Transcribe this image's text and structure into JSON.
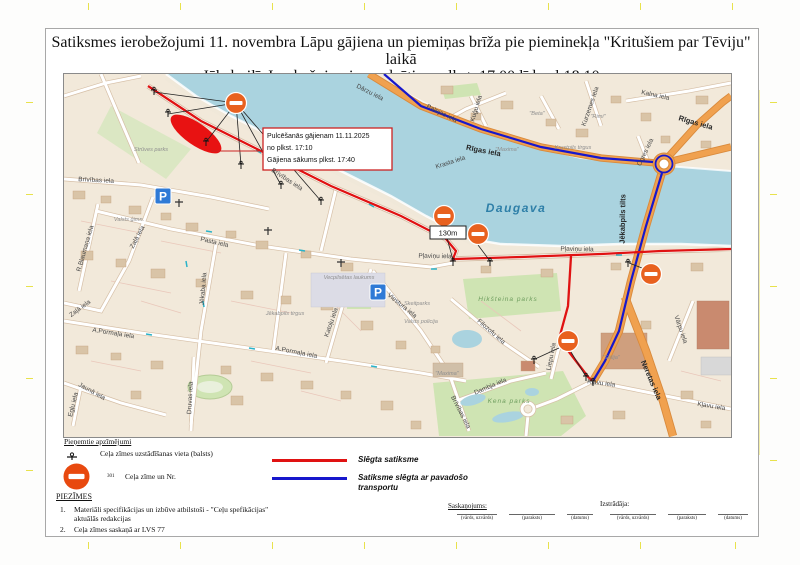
{
  "title": {
    "line1": "Satiksmes ierobežojumi 11. novembra Lāpu gājiena un piemiņas brīža pie pieminekļa \"Kritušiem par Tēviju\" laikā",
    "line2": "Jēkabpilī. Ierobežojumi paredzēti no plkst. 17.00 līdz pl.18.10"
  },
  "map": {
    "parking_letter": "P",
    "distance_label": "130m",
    "callout": {
      "line1": "Pulcēšanās gājienam 11.11.2025",
      "line2": "no plkst. 17:10",
      "line3": "Gājiena sākums plkst. 17:40"
    },
    "labels": [
      "Strūves parks",
      "Brīvības iela",
      "Brīvības iela",
      "Zaļā iela",
      "Pasta iela",
      "R.Blaumaņa iela",
      "Jēkaba iela",
      "A.Pormaļa iela",
      "A.Pormaļa iela",
      "Jaunā iela",
      "Egļu iela",
      "Druvas iela",
      "Katoļu iela",
      "Viestura iela",
      "Vecpilsētas laukums",
      "Jēkabpils tirgus",
      "Daugava",
      "Rīgas iela",
      "Rīgas iela",
      "Palejas iela",
      "Kalna iela",
      "Kuģu iela",
      "Krasta iela",
      "Ogres iela",
      "Kurzemes iela",
      "Krustpils tirgus",
      "\"Maxima\"",
      "\"Rimi\"",
      "\"Beta\"",
      "Jēkabpils tilts",
      "Pļaviņu iela",
      "Pļaviņu iela",
      "Hikšteina parks",
      "Skeitparks",
      "Valsts policija",
      "\"Maxima\"",
      "Filozofu iela",
      "Dambja iela",
      "Kena parks",
      "\"Sēlija\"",
      "Neretas iela",
      "Vārpu iela",
      "Kļavu iela",
      "Kļavu iela",
      "Liepu iela",
      "Valsts ģimn.",
      "Dārzu iela",
      "Zaļā iela",
      "Brīvības iela"
    ]
  },
  "legend": {
    "heading": "Pieņemtie apzīmējumi",
    "item1_label": "Ceļa zīmes uzstādīšanas vieta (balsts)",
    "item2_number": "301",
    "item2_label": "Ceļa zīme un Nr.",
    "line1_label": "Slēgta satiksme",
    "line2_label": "Satiksme slēgta ar pavadošo transportu",
    "line1_color": "#e01212",
    "line2_color": "#1717cc"
  },
  "notes": {
    "heading": "PIEZĪMES",
    "item1_num": "1.",
    "item1": "Materiāli specifikācijas un izbūve atbilstoši - \"Ceļu spefikācijas\" aktuālās redakcijas",
    "item2_num": "2.",
    "item2": "Ceļa zīmes saskaņā ar LVS 77"
  },
  "signoff": {
    "left_heading": "Saskaņojums:",
    "right_heading": "Izstrādāja:",
    "fields": [
      "(vārds, uzvārds)",
      "(paraksts)",
      "(datums)"
    ]
  }
}
